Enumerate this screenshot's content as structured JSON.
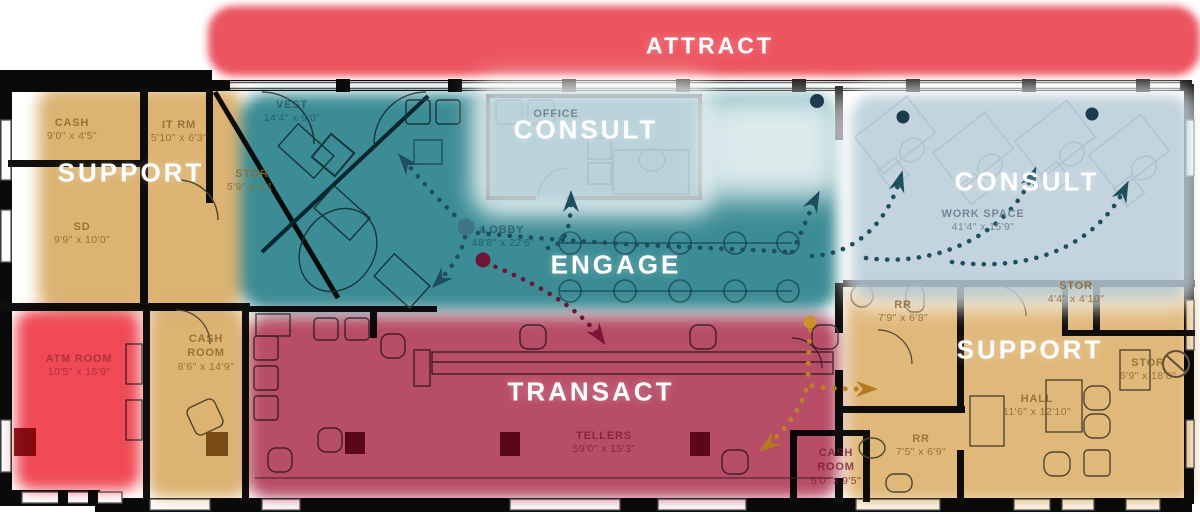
{
  "diagram_title": "bank branch zone floor plan",
  "zones": {
    "attract": {
      "label": "ATTRACT",
      "color": "#ec5560"
    },
    "support_left": {
      "label": "SUPPORT",
      "color": "#dcb372"
    },
    "consult_left": {
      "label": "CONSULT",
      "color": "#b8ccd8"
    },
    "engage": {
      "label": "ENGAGE",
      "color": "#3c8c95"
    },
    "consult_right": {
      "label": "CONSULT",
      "color": "#b8ccd8"
    },
    "transact": {
      "label": "TRANSACT",
      "color": "#b84d67"
    },
    "support_right": {
      "label": "SUPPORT",
      "color": "#e0b87a"
    }
  },
  "rooms": [
    {
      "name": "CASH",
      "dims": "9'0\" x 4'5\""
    },
    {
      "name": "IT RM",
      "dims": "5'10\" x 6'3\""
    },
    {
      "name": "STOR",
      "dims": "5'9\" x 9'1\""
    },
    {
      "name": "SD",
      "dims": "9'9\" x 10'0\""
    },
    {
      "name": "VEST",
      "dims": "14'4\" x 9'0\""
    },
    {
      "name": "OFFICE",
      "dims": ""
    },
    {
      "name": "LOBBY",
      "dims": "48'8\" x 22'6\""
    },
    {
      "name": "WORK SPACE",
      "dims": "41'4\" x 15'9\""
    },
    {
      "name": "ATM ROOM",
      "dims": "10'5\" x 15'9\""
    },
    {
      "name": "CASH ROOM",
      "dims": "8'6\" x 14'9\""
    },
    {
      "name": "TELLERS",
      "dims": "59'0\" x 15'3\""
    },
    {
      "name": "RR",
      "dims": "7'9\" x 6'8\""
    },
    {
      "name": "STOR",
      "dims": "4'4\" x 4'10\""
    },
    {
      "name": "STOR",
      "dims": "6'9\" x 18'0\""
    },
    {
      "name": "HALL",
      "dims": "11'6\" x 12'10\""
    },
    {
      "name": "RR",
      "dims": "7'5\" x 6'9\""
    },
    {
      "name": "CASH ROOM",
      "dims": "5'0\" x 9'5\""
    }
  ],
  "flow_paths": {
    "engage_color": "#1d4f5f",
    "transact_color": "#6d1537",
    "support_color": "#bd8124"
  }
}
